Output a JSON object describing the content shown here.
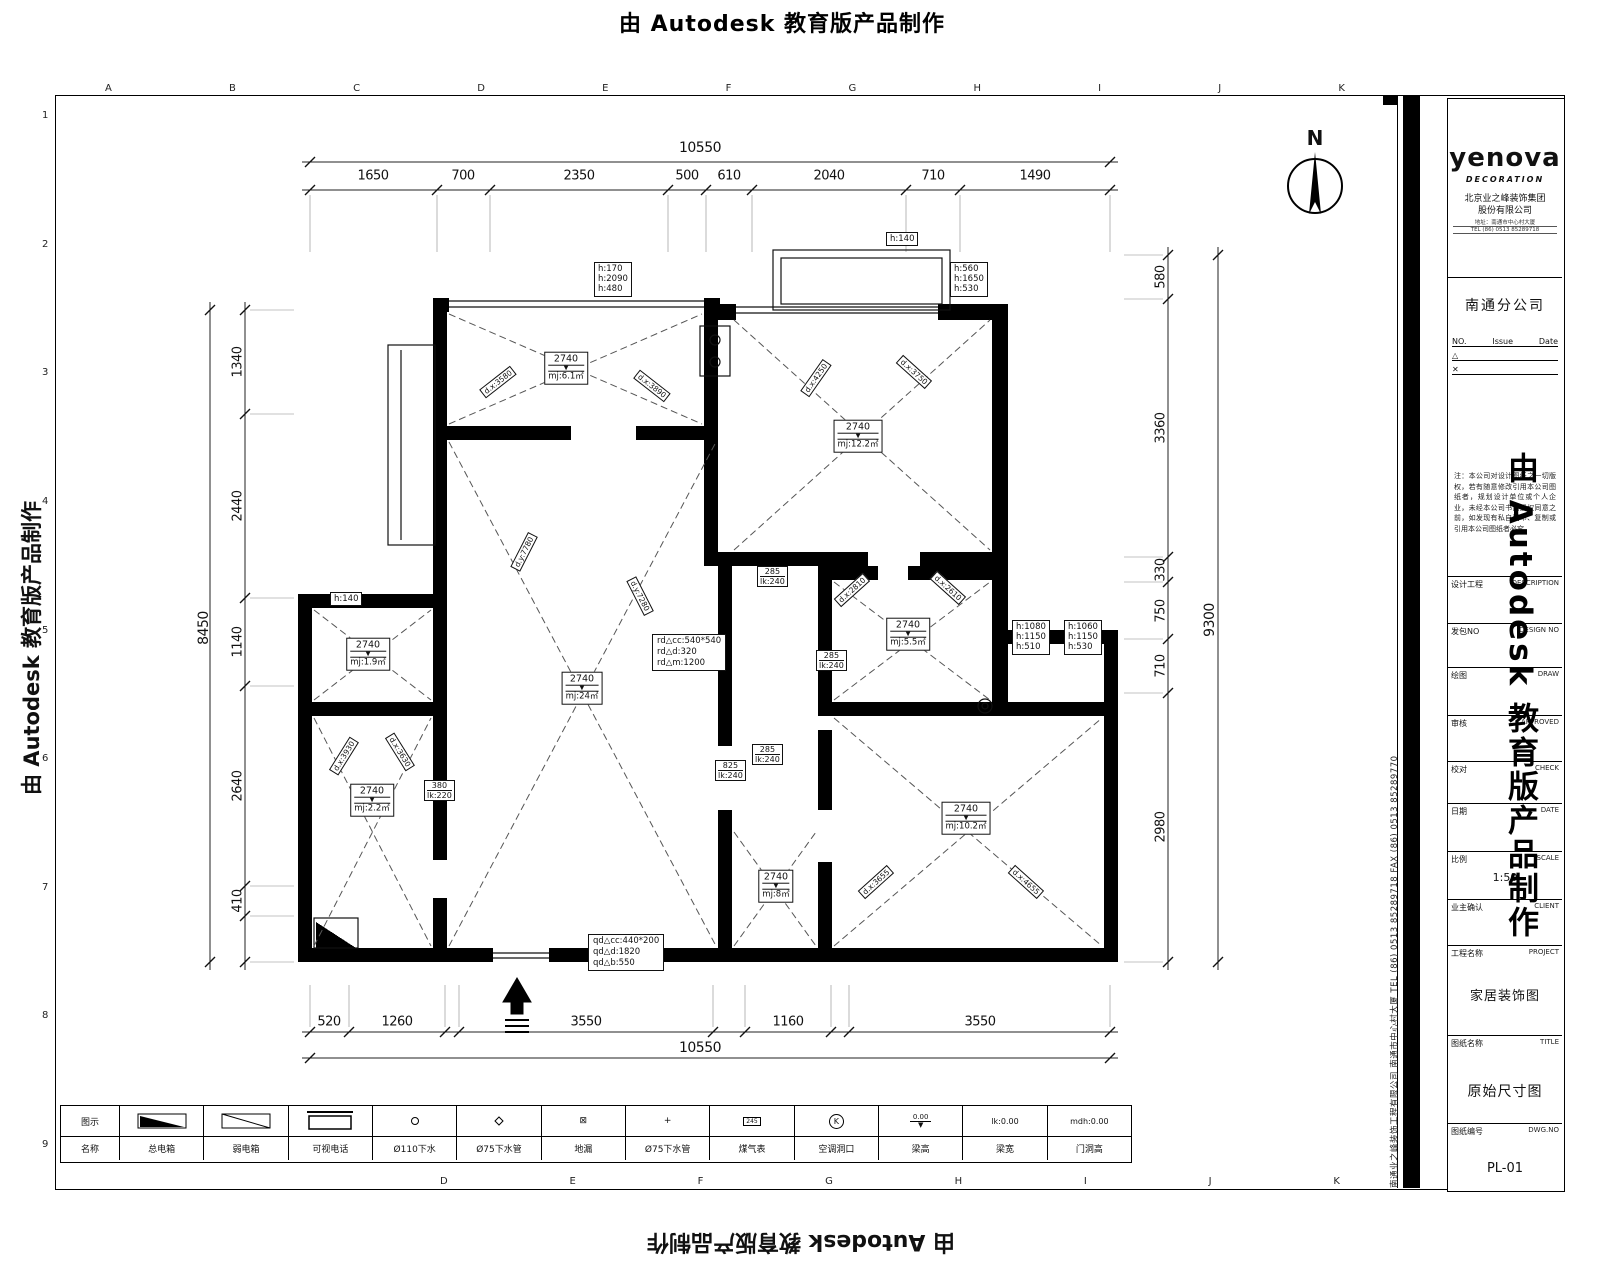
{
  "watermark": {
    "text": "由 Autodesk 教育版产品制作"
  },
  "north": {
    "letter": "N"
  },
  "grid": {
    "top_letters": [
      "A",
      "B",
      "C",
      "D",
      "E",
      "F",
      "G",
      "H",
      "I",
      "J",
      "K"
    ],
    "bottom_letters": [
      "D",
      "E",
      "F",
      "G",
      "H",
      "I",
      "J",
      "K"
    ],
    "left_numbers": [
      "1",
      "2",
      "3",
      "4",
      "5",
      "6",
      "7",
      "8",
      "9"
    ]
  },
  "dimensions": {
    "top": {
      "total": "10550",
      "segments": [
        "1650",
        "700",
        "2350",
        "500",
        "610",
        "2040",
        "710",
        "1490"
      ]
    },
    "bottom": {
      "total": "10550",
      "segments": [
        "520",
        "1260",
        "3550",
        "1160",
        "3550"
      ]
    },
    "left": {
      "total": "8450",
      "segments": [
        "1340",
        "2440",
        "1140",
        "2640",
        "410"
      ]
    },
    "right": {
      "total": "9300",
      "segments": [
        "580",
        "3360",
        "330",
        "750",
        "710",
        "2980"
      ]
    }
  },
  "plan": {
    "level_symbol": "▼",
    "rooms": [
      {
        "height": "2740",
        "area": "mj:6.1㎡"
      },
      {
        "height": "2740",
        "area": "mj:12.2㎡"
      },
      {
        "height": "2740",
        "area": "mj:1.9㎡"
      },
      {
        "height": "2740",
        "area": "mj:2.2㎡"
      },
      {
        "height": "2740",
        "area": "mj:24㎡"
      },
      {
        "height": "2740",
        "area": "mj:5.5㎡"
      },
      {
        "height": "2740",
        "area": "mj:8㎡"
      },
      {
        "height": "2740",
        "area": "mj:10.2㎡"
      }
    ],
    "height_boxes": [
      {
        "lines": [
          "h:170",
          "h:2090",
          "h:480"
        ]
      },
      {
        "lines": [
          "h:560",
          "h:1650",
          "h:530"
        ]
      },
      {
        "lines": [
          "h:140"
        ]
      },
      {
        "lines": [
          "h:140"
        ]
      },
      {
        "lines": [
          "h:1080",
          "h:1150",
          "h:510"
        ]
      },
      {
        "lines": [
          "h:1060",
          "h:1150",
          "h:530"
        ]
      }
    ],
    "beam_labels": [
      {
        "value": "285",
        "beam": "lk:240"
      },
      {
        "value": "285",
        "beam": "lk:240"
      },
      {
        "value": "285",
        "beam": "lk:240"
      },
      {
        "value": "825",
        "beam": "lk:240"
      },
      {
        "value": "380",
        "beam": "lk:220"
      }
    ],
    "diagonals": [
      "d.x:3580",
      "d.x:3890",
      "d.x:4250",
      "d.x:3750",
      "d.y:7780",
      "d.y:7280",
      "d.x:3930",
      "d.x:3630",
      "d.x:2810",
      "d.x:2610",
      "d.x:3655",
      "d.x:4655"
    ],
    "rd_note": [
      "rd△cc:540*540",
      "rd△d:320",
      "rd△m:1200"
    ],
    "qd_note": [
      "qd△cc:440*200",
      "qd△d:1820",
      "qd△b:550"
    ]
  },
  "legend": {
    "symbol_header": "图示",
    "name_header": "名称",
    "names": [
      "总电箱",
      "弱电箱",
      "可视电话",
      "Ø110下水",
      "Ø75下水管",
      "地漏",
      "Ø75下水管",
      "煤气表",
      "空调洞口",
      "梁高",
      "梁宽",
      "门洞高"
    ],
    "plus_symbol": "+",
    "drain_symbol": "⊠",
    "meter_digits": "245",
    "k_letter": "K",
    "level_value": "0.00",
    "lk_value": "lk:0.00",
    "mdh_value": "mdh:0.00"
  },
  "titleblock": {
    "logo": "yenova",
    "logo_sub": "DECORATION",
    "company_line1": "北京业之峰装饰集团",
    "company_line2": "股份有限公司",
    "address_line1": "地址：南通市中心村大厦",
    "address_line2": "TEL (86) 0513 85289718",
    "branch": "南通分公司",
    "issue_no": "NO.",
    "issue": "Issue",
    "date": "Date",
    "rev1": "△",
    "rev2": "✕",
    "disclaimer": "注：本公司对设计图纸之一切版权，若有随意修改引用本公司图纸者，规划设计单位或个人企业，未经本公司书面授权同意之前，如发现有私自翻印、复制或引用本公司图纸者必究。",
    "fields": [
      {
        "label": "设计工程",
        "en": "DESCRIPTION"
      },
      {
        "label": "发包NO",
        "en": "DESIGN NO"
      },
      {
        "label": "绘图",
        "en": "DRAW"
      },
      {
        "label": "审核",
        "en": "APPROVED"
      },
      {
        "label": "校对",
        "en": "CHECK"
      },
      {
        "label": "日期",
        "en": "DATE"
      },
      {
        "label": "比例",
        "en": "SCALE"
      },
      {
        "label": "业主确认",
        "en": "CLIENT"
      },
      {
        "label": "工程名称",
        "en": "PROJECT"
      },
      {
        "label": "图纸名称",
        "en": "TITLE"
      },
      {
        "label": "图纸编号",
        "en": "DWG.NO"
      }
    ],
    "scale_value": "1:50",
    "project_value": "家居装饰图",
    "title_value": "原始尺寸图",
    "dwg_value": "PL-01",
    "side_text": "南通业之峰装饰工程有限公司  南通市中心村大厦  TEL (86) 0513 85289718  FAX (86) 0513 85289770"
  }
}
